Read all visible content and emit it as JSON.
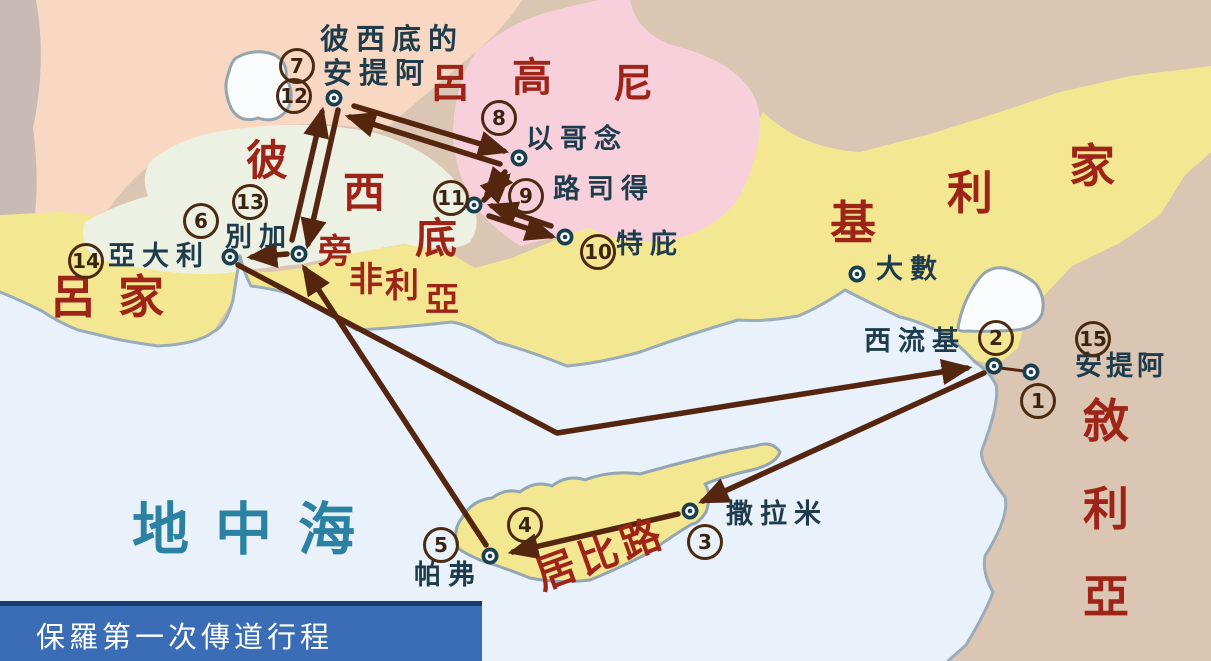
{
  "title_bar": {
    "label": "保羅第一次傳道行程"
  },
  "sea": {
    "label": "地中海"
  },
  "regions": {
    "lycaonia": {
      "name": "呂高尼",
      "chars": [
        "呂",
        "高",
        "尼"
      ]
    },
    "pisidia": {
      "name": "彼西底",
      "chars": [
        "彼",
        "西",
        "底"
      ]
    },
    "pamphylia": {
      "name": "旁非利亞",
      "chars": [
        "旁",
        "非",
        "利",
        "亞"
      ]
    },
    "lycia": {
      "name": "呂家",
      "label": "呂家"
    },
    "cilicia": {
      "name": "基利家",
      "chars": [
        "基",
        "利",
        "家"
      ]
    },
    "syria": {
      "name": "敘利亞",
      "chars": [
        "敘",
        "利",
        "亞"
      ]
    },
    "cyprus": {
      "name": "居比路",
      "label": "居比路"
    }
  },
  "cities": {
    "pisidian_antioch": {
      "line1": "彼西底的",
      "line2": "安提阿"
    },
    "iconium": {
      "label": "以哥念"
    },
    "lystra": {
      "label": "路司得"
    },
    "derbe": {
      "label": "特庇"
    },
    "perga": {
      "label": "別加"
    },
    "attalia": {
      "label": "亞大利"
    },
    "tarsus": {
      "label": "大數"
    },
    "seleucia": {
      "label": "西流基"
    },
    "antioch_syria": {
      "label": "安提阿"
    },
    "salamis": {
      "label": "撒拉米"
    },
    "paphos": {
      "label": "帕弗"
    }
  },
  "waypoints": [
    {
      "n": "1",
      "at": "安提阿"
    },
    {
      "n": "2",
      "at": "西流基"
    },
    {
      "n": "3",
      "at": "撒拉米"
    },
    {
      "n": "4",
      "at": "居比路"
    },
    {
      "n": "5",
      "at": "帕弗"
    },
    {
      "n": "6",
      "at": "別加"
    },
    {
      "n": "7",
      "at": "彼西底的安提阿"
    },
    {
      "n": "8",
      "at": "以哥念"
    },
    {
      "n": "9",
      "at": "路司得"
    },
    {
      "n": "10",
      "at": "特庇"
    },
    {
      "n": "11",
      "at": "路司得"
    },
    {
      "n": "12",
      "at": "彼西底的安提阿"
    },
    {
      "n": "13",
      "at": "別加"
    },
    {
      "n": "14",
      "at": "亞大利"
    },
    {
      "n": "15",
      "at": "安提阿"
    }
  ],
  "routes": [
    {
      "from": "安提阿",
      "to": "西流基"
    },
    {
      "from": "西流基",
      "to": "撒拉米"
    },
    {
      "from": "撒拉米",
      "to": "帕弗"
    },
    {
      "from": "帕弗",
      "to": "別加"
    },
    {
      "from": "別加",
      "to": "彼西底的安提阿"
    },
    {
      "from": "彼西底的安提阿",
      "to": "以哥念"
    },
    {
      "from": "以哥念",
      "to": "路司得"
    },
    {
      "from": "路司得",
      "to": "特庇"
    },
    {
      "from": "特庇",
      "to": "路司得"
    },
    {
      "from": "路司得",
      "to": "以哥念"
    },
    {
      "from": "以哥念",
      "to": "彼西底的安提阿"
    },
    {
      "from": "彼西底的安提阿",
      "to": "別加"
    },
    {
      "from": "別加",
      "to": "亞大利"
    },
    {
      "from": "亞大利",
      "to": "西流基"
    }
  ],
  "colors": {
    "sea": "#e9f1fa",
    "land_tan": "#dbc5b3",
    "land_peach": "#f8d8c2",
    "land_gray": "#c9bab6",
    "land_yellow": "#f4e792",
    "region_pink": "#f8d0dc",
    "region_pale": "#edf1e3",
    "coastline": "#9aacb9",
    "route_brown": "#54250f",
    "region_label_red": "#9e2418",
    "city_label": "#1f3c4c",
    "sea_label": "#2b81a1",
    "title_bg": "#3a6db5",
    "title_text": "#ffffff"
  }
}
